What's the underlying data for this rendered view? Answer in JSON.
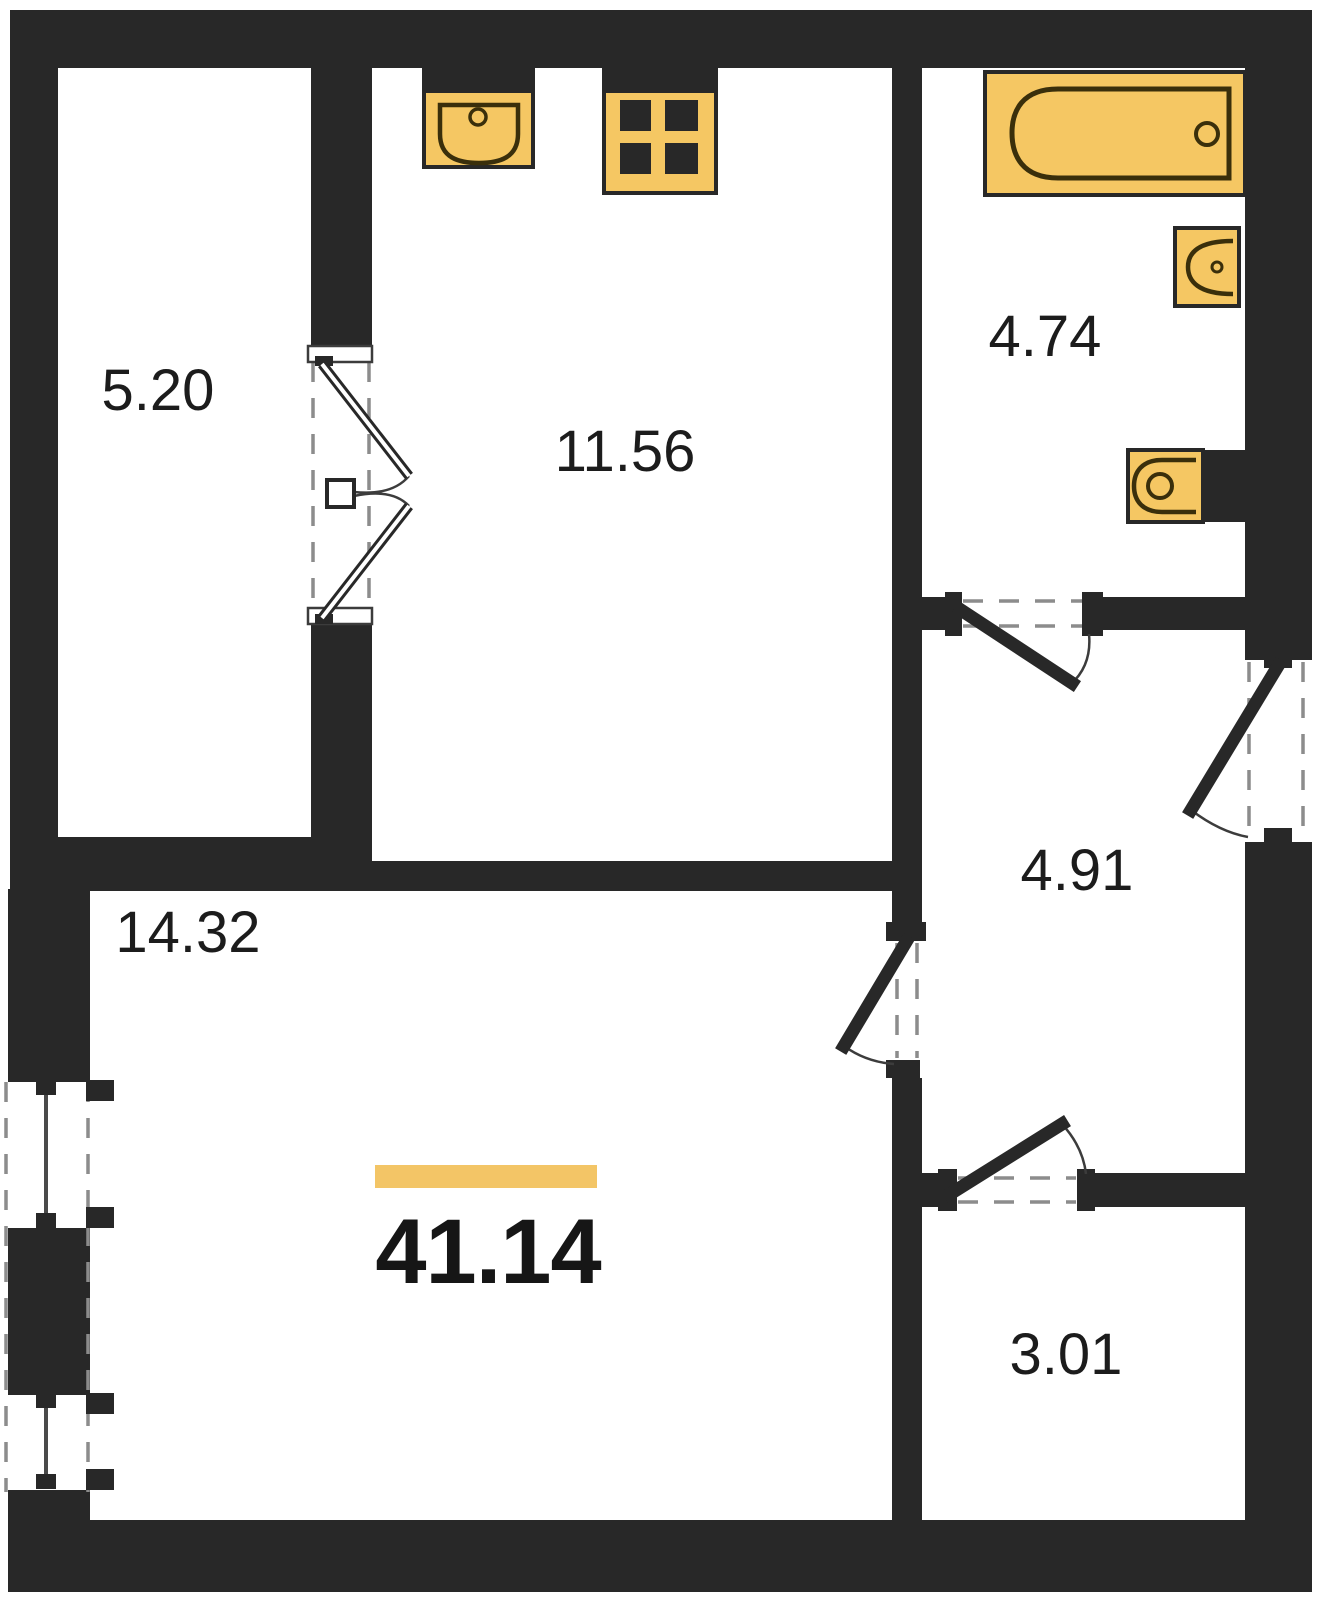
{
  "plan": {
    "type": "apartment-floor-plan",
    "total_area": "41.14",
    "rooms": [
      {
        "name": "balcony",
        "area": "5.20"
      },
      {
        "name": "kitchen",
        "area": "11.56"
      },
      {
        "name": "bathroom",
        "area": "4.74"
      },
      {
        "name": "hallway",
        "area": "4.91"
      },
      {
        "name": "living-room",
        "area": "14.32"
      },
      {
        "name": "storage",
        "area": "3.01"
      }
    ],
    "fixtures": [
      "kitchen-sink-icon",
      "stove-icon",
      "bathtub-icon",
      "washbasin-icon",
      "toilet-icon"
    ],
    "doors": [
      "balcony-double-door",
      "bathroom-door",
      "entry-door",
      "living-room-door",
      "storage-door"
    ],
    "windows": [
      "living-room-window-upper",
      "living-room-window-lower"
    ],
    "colors": {
      "wall": "#282828",
      "fixture_fill": "#f5c763",
      "fixture_line": "#3a2f0b",
      "accent_bar": "#f3c566",
      "dash": "#8c8c8c",
      "text": "#1c1c1c",
      "background": "#ffffff"
    }
  }
}
